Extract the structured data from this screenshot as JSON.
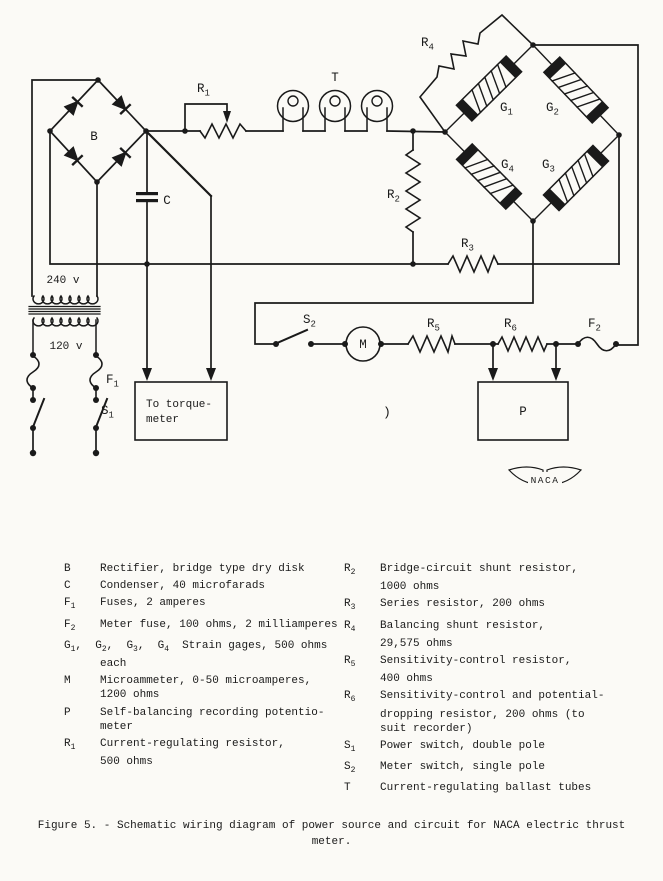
{
  "page": {
    "ink": "#1a1a1a",
    "paper": "#fbfaf6"
  },
  "schematic": {
    "labels": {
      "b": "B",
      "c": "C",
      "t": "T",
      "m": "M",
      "p": "P",
      "naca": "NACA",
      "v240": "240 v",
      "v120": "120 v",
      "r1": {
        "base": "R",
        "sub": "1"
      },
      "r2": {
        "base": "R",
        "sub": "2"
      },
      "r3": {
        "base": "R",
        "sub": "3"
      },
      "r4": {
        "base": "R",
        "sub": "4"
      },
      "r5": {
        "base": "R",
        "sub": "5"
      },
      "r6": {
        "base": "R",
        "sub": "6"
      },
      "f1": {
        "base": "F",
        "sub": "1"
      },
      "f2": {
        "base": "F",
        "sub": "2"
      },
      "s1": {
        "base": "S",
        "sub": "1"
      },
      "s2": {
        "base": "S",
        "sub": "2"
      },
      "g1": {
        "base": "G",
        "sub": "1"
      },
      "g2": {
        "base": "G",
        "sub": "2"
      },
      "g3": {
        "base": "G",
        "sub": "3"
      },
      "g4": {
        "base": "G",
        "sub": "4"
      },
      "torque1": "To torque-",
      "torque2": "meter",
      "stray": ")"
    }
  },
  "legend": {
    "left": [
      {
        "sym": "B",
        "lines": [
          "Rectifier, bridge type dry disk"
        ]
      },
      {
        "sym": "C",
        "lines": [
          "Condenser, 40 microfarads"
        ]
      },
      {
        "sym": "F_1",
        "lines": [
          "Fuses, 2 amperes"
        ]
      },
      {
        "sym": "F_2",
        "lines": [
          "Meter fuse, 100 ohms, 2 milliamperes"
        ]
      },
      {
        "sym": "G_1,  G_2,  G_3,  G_4",
        "wide": true,
        "lines": [
          "Strain gages, 500 ohms",
          "each"
        ]
      },
      {
        "sym": "M",
        "lines": [
          "Microammeter, 0-50 microamperes,",
          "1200 ohms"
        ]
      },
      {
        "sym": "P",
        "lines": [
          "Self-balancing recording potentio-",
          "meter"
        ]
      },
      {
        "sym": "R_1",
        "lines": [
          "Current-regulating resistor,",
          "500 ohms"
        ]
      }
    ],
    "right": [
      {
        "sym": "R_2",
        "lines": [
          "Bridge-circuit shunt resistor,",
          "1000 ohms"
        ]
      },
      {
        "sym": "R_3",
        "lines": [
          "Series resistor, 200 ohms"
        ]
      },
      {
        "sym": "R_4",
        "lines": [
          "Balancing shunt resistor,",
          "29,575 ohms"
        ]
      },
      {
        "sym": "R_5",
        "lines": [
          "Sensitivity-control resistor,",
          "400 ohms"
        ]
      },
      {
        "sym": "R_6",
        "lines": [
          "Sensitivity-control and potential-",
          "dropping resistor, 200 ohms (to",
          "suit recorder)"
        ]
      },
      {
        "sym": "S_1",
        "lines": [
          "Power switch, double pole"
        ]
      },
      {
        "sym": "S_2",
        "lines": [
          "Meter switch, single pole"
        ]
      },
      {
        "sym": "T",
        "lines": [
          "Current-regulating ballast tubes"
        ]
      }
    ]
  },
  "caption": {
    "line1": "Figure 5. - Schematic wiring diagram of power source and circuit for NACA electric thrust",
    "line2": "meter."
  }
}
